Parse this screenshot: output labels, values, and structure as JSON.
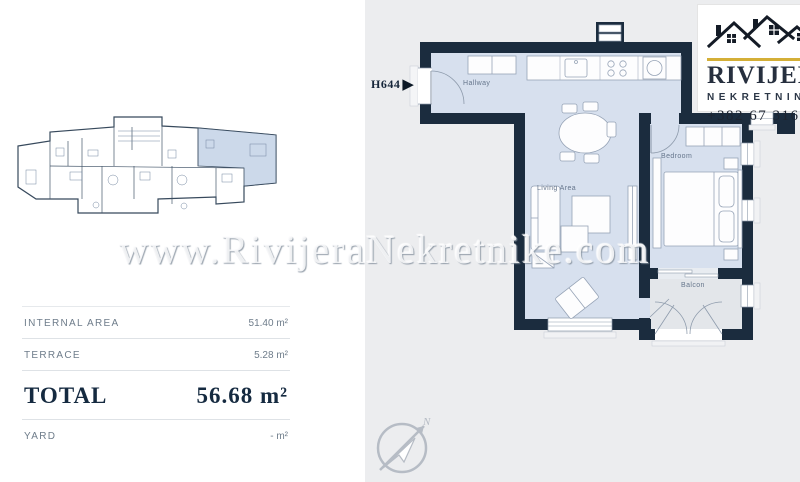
{
  "branding": {
    "agency_name": "RIVIJERA",
    "agency_subtitle": "NEKRETNINE",
    "phone": "+382 67 316 0",
    "gold_accent": "#d4af37",
    "text_color": "#262f3e"
  },
  "watermark": {
    "text": "www.RivijeraNekretnike.com"
  },
  "unit": {
    "code": "H644",
    "arrow": "▶"
  },
  "floor_plan": {
    "wall_color": "#1b2c3e",
    "floor_color": "#d7e0ee",
    "balcony_floor_color": "#e3e6ea",
    "background_color": "#ecedef",
    "rooms": [
      {
        "name": "Hallway"
      },
      {
        "name": "Living Area"
      },
      {
        "name": "Bedroom"
      },
      {
        "name": "Balcon"
      }
    ]
  },
  "overview_plan": {
    "highlight_color": "#ccd9ea"
  },
  "area_table": {
    "rows": [
      {
        "label": "INTERNAL AREA",
        "value": "51.40 m²"
      },
      {
        "label": "TERRACE",
        "value": "5.28 m²"
      },
      {
        "label": "TOTAL",
        "value": "56.68 m²"
      },
      {
        "label": "YARD",
        "value": "- m²"
      }
    ]
  },
  "compass": {
    "north_label": "N"
  }
}
